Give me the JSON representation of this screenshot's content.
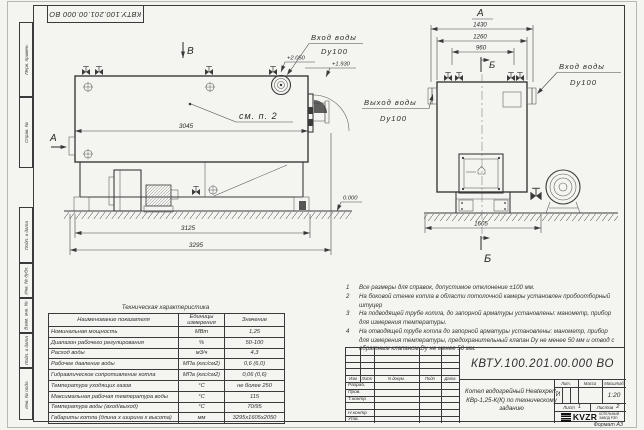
{
  "sheet": {
    "doc_number_top": "КВТУ.100.201.00.000 ВО",
    "format_note": "Формат А3",
    "margin_labels": [
      "Перв. примен.",
      "Справ. №",
      "Подп. и дата",
      "Инв. № дубл.",
      "Взам. инв. №",
      "Подп. и дата",
      "Инв. № подл."
    ]
  },
  "drawing": {
    "side_view": {
      "view_arrow_top": "В",
      "view_arrow_left": "А",
      "callout_see_item": "см. п. 2",
      "dim_shell_length": "3045",
      "dim_frame_length": "3125",
      "dim_overall_length": "3295",
      "level_top": "+2.050",
      "level_inlet": "+1.930",
      "level_ground": "0.000",
      "inlet_line1": "Вход воды",
      "inlet_line2": "Dy100"
    },
    "front_view": {
      "view_label": "А",
      "section_label_top": "Б",
      "section_label_bottom": "Б",
      "dim_overall_width": "1430",
      "dim_shell_width": "1260",
      "dim_valve_spacing": "960",
      "dim_base_width": "1605",
      "outlet_line1": "Выход воды",
      "outlet_line2": "Dy100",
      "inlet_line1": "Вход воды",
      "inlet_line2": "Dy100"
    }
  },
  "notes": [
    {
      "num": "1",
      "text": "Все размеры для справок, допустимое отклонение ±100 мм."
    },
    {
      "num": "2",
      "text": "На боковой стенке котла в области потолочной камеры установлен пробоотборный штуцер"
    },
    {
      "num": "3",
      "text": "На подводящей трубе котла, до запорной арматуры установлены: манометр, прибор для измерения температуры."
    },
    {
      "num": "4",
      "text": "На отводящей трубе котла до запорной арматуры установлены: манометр, прибор для измерения температуры, предохранительный клапан Dy не менее 50 мм и отвод с обратным клапаном Dy не менее 50 мм."
    }
  ],
  "tech_table": {
    "title": "Техническая характеристика",
    "headers": [
      "Наименование показателя",
      "Единицы измерения",
      "Значение"
    ],
    "rows": [
      [
        "Номинальная мощность",
        "МВт",
        "1,25"
      ],
      [
        "Диапазон рабочего регулирования",
        "%",
        "50-100"
      ],
      [
        "Расход воды",
        "м3/ч",
        "4,3"
      ],
      [
        "Рабочее давление воды",
        "МПа (кгс/см2)",
        "0,6 (6,0)"
      ],
      [
        "Гидравлическое сопротивление котла",
        "МПа (кгс/см2)",
        "0,06 (0,6)"
      ],
      [
        "Температура уходящих газов",
        "°С",
        "не более 250"
      ],
      [
        "Максимальная рабочая температура воды",
        "°С",
        "115"
      ],
      [
        "Температура воды (вход/выход)",
        "°С",
        "70/95"
      ],
      [
        "Габариты котла (длина х ширина х высота)",
        "мм",
        "3295х1605х2050"
      ]
    ]
  },
  "title_block": {
    "doc_number": "КВТУ.100.201.00.000 ВО",
    "header_cols": [
      "Изм",
      "Лист",
      "N докум.",
      "Подп",
      "Дата"
    ],
    "row_labels": [
      "Разраб.",
      "Пров.",
      "Т.контр",
      "Н.контр",
      "Утв."
    ],
    "title": "Котел водогрейный Heatexpert-КВр-1,25-К(К) по техническому заданию",
    "lit_label": "Лит.",
    "lit_value": "И",
    "mass_label": "Масса",
    "scale_label": "Масштаб",
    "scale_value": "1:20",
    "sheet_label": "Лист",
    "sheet_value": "1",
    "sheets_label": "Листов",
    "sheets_value": "2",
    "company_logo": "KVZR",
    "company_line1": "КОТЕЛЬНЫЙ",
    "company_line2": "ЗАВОД РЭП"
  }
}
